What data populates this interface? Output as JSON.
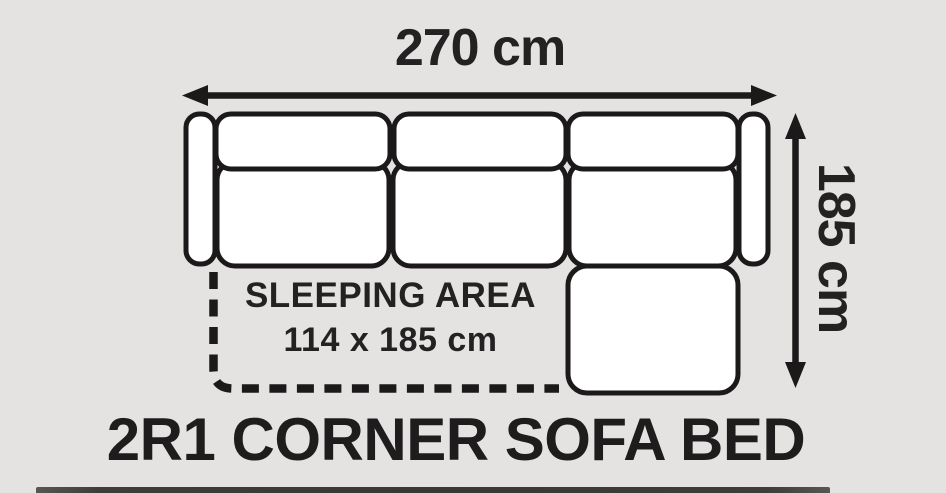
{
  "labels": {
    "width": "270 cm",
    "height": "185 cm",
    "sleeping_area_line1": "SLEEPING AREA",
    "sleeping_area_line2": "114 x 185 cm",
    "title": "2R1 CORNER SOFA BED"
  },
  "colors": {
    "background": "#e4e3e1",
    "outline": "#1b191a",
    "cushion_fill": "#ffffff",
    "text": "#232122",
    "bottom_strip": "#3f3c39"
  }
}
